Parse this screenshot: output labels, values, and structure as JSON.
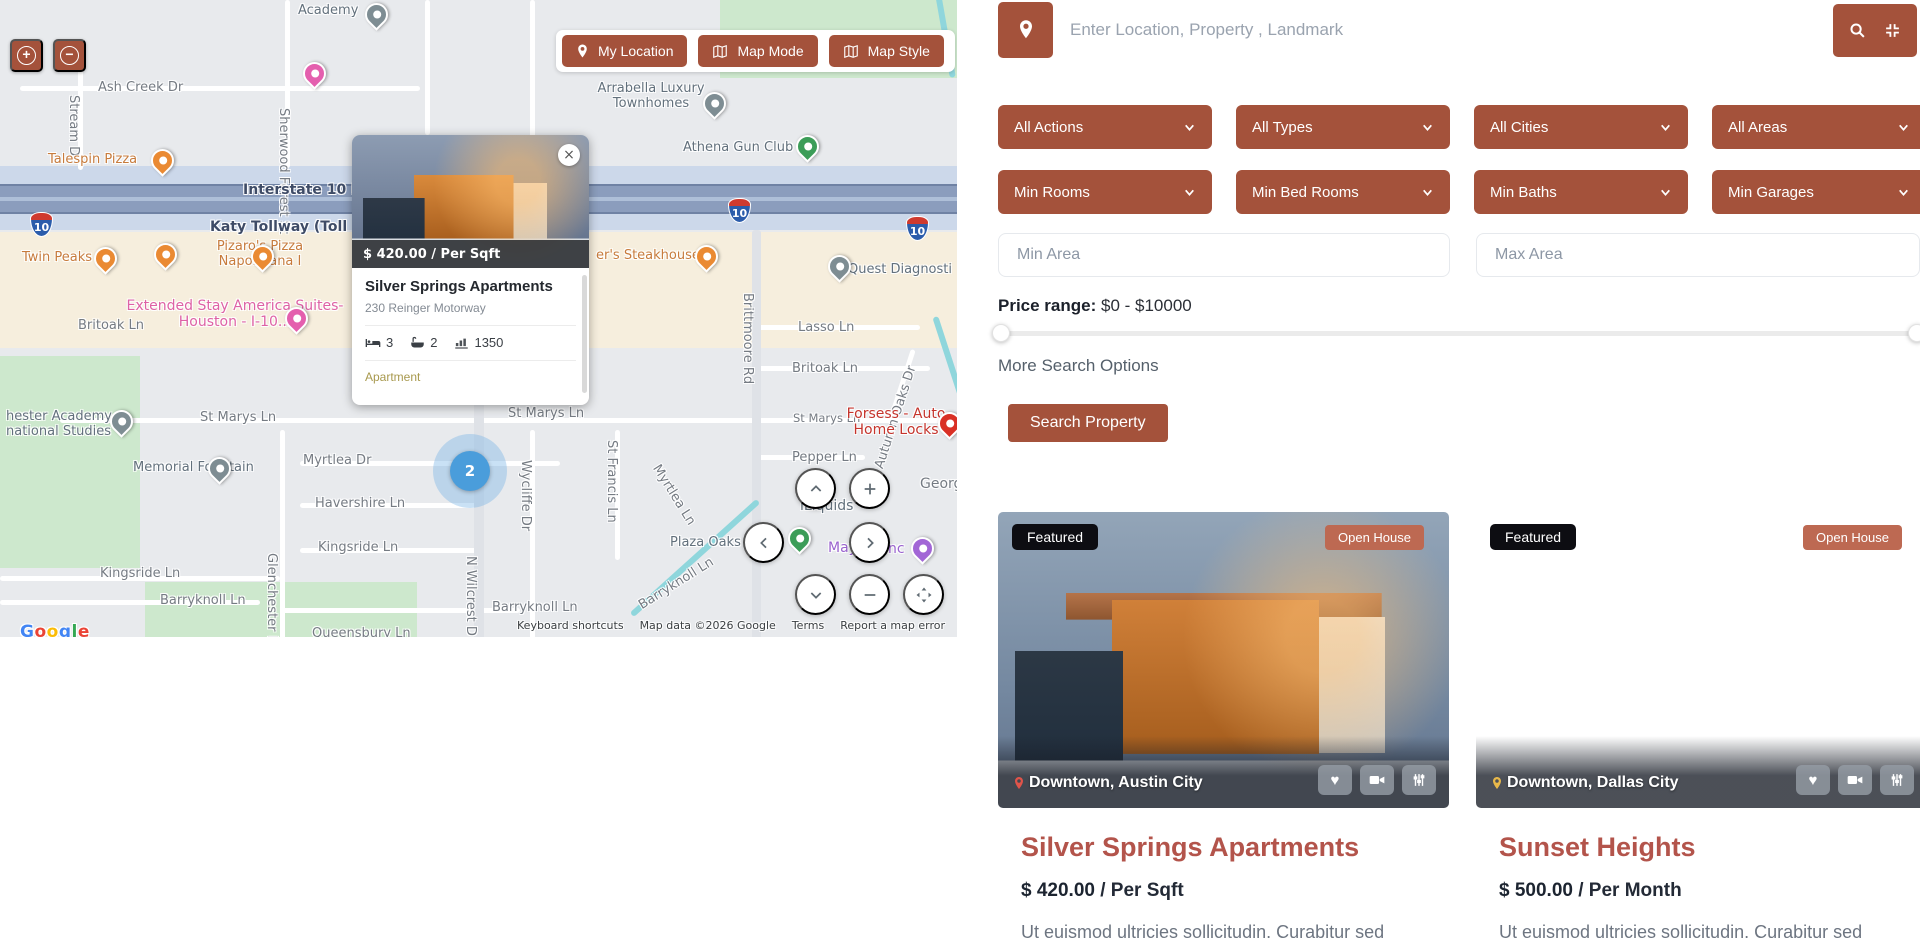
{
  "map": {
    "zoom_in": "+",
    "zoom_out": "−",
    "controls": [
      "My Location",
      "Map Mode",
      "Map Style"
    ],
    "cluster_count": "2",
    "shields": [
      "10",
      "10",
      "10"
    ],
    "labels": [
      "Academy",
      "Ash Creek Dr",
      "Stream Dr",
      "Sherwood Forest St",
      "Arrabella Luxury Townhomes",
      "Athena Gun Club",
      "Talespin Pizza",
      "Interstate 10 Fr",
      "Katy Tollway (Toll roa",
      "Twin Peaks",
      "Pizaro's Pizza Napoletana I",
      "er's Steakhouse",
      "Quest Diagnosti",
      "Extended Stay America Suites- Houston - I-10...",
      "Britoak Ln",
      "Brittmoore Rd",
      "Lasso Ln",
      "Britoak Ln",
      "Autumn Oaks Dr",
      "St Marys Ln",
      "St Marys Ln",
      "St Marys Ln",
      "Forsess - Auto Home Locks",
      "Pepper Ln",
      "hester Academy national Studies",
      "Memorial Fountain",
      "Myrtlea Dr",
      "Wycliffe Dr",
      "St Francis Ln",
      "Myrtlea Ln",
      "Havershire Ln",
      "Plaza Oaks",
      "Kingsride Ln",
      "Kingsride Ln",
      "Glenchester Dr",
      "Barryknoll Ln",
      "Barryknoll Ln",
      "Barryknoll Ln",
      "N Wilcrest D",
      "Queensbury Ln",
      "iLiquids",
      "Mayu",
      "nc",
      "Georg"
    ],
    "popup": {
      "price": "$ 420.00 / Per Sqft",
      "close": "×",
      "title": "Silver Springs Apartments",
      "address": "230 Reinger Motorway",
      "beds": "3",
      "baths": "2",
      "area": "1350",
      "category": "Apartment"
    },
    "google_letters": [
      "G",
      "o",
      "o",
      "g",
      "l",
      "e"
    ],
    "attribution": {
      "keyboard_shortcuts": "Keyboard shortcuts",
      "map_data": "Map data ©2026 Google",
      "terms": "Terms",
      "report_error": "Report a map error"
    }
  },
  "search": {
    "placeholder": "Enter Location, Property , Landmark",
    "filters": [
      "All Actions",
      "All Types",
      "All Cities",
      "All Areas",
      "Min Rooms",
      "Min Bed Rooms",
      "Min Baths",
      "Min Garages"
    ],
    "min_area_placeholder": "Min Area",
    "max_area_placeholder": "Max Area",
    "price_range_label": "Price range:",
    "price_range_value": "$0 - $10000",
    "more_options": "More Search Options",
    "search_button": "Search Property"
  },
  "listings": [
    {
      "featured_badge": "Featured",
      "open_house_badge": "Open House",
      "location": "Downtown, Austin City",
      "title": "Silver Springs Apartments",
      "price": "$ 420.00",
      "price_suffix": "/ Per Sqft",
      "description": "Ut euismod ultricies sollicitudin. Curabitur sed"
    },
    {
      "featured_badge": "Featured",
      "open_house_badge": "Open House",
      "location": "Downtown, Dallas City",
      "title": "Sunset Heights",
      "price": "$ 500.00",
      "price_suffix": "/ Per Month",
      "description": "Ut euismod ultricies sollicitudin. Curabitur sed"
    }
  ]
}
